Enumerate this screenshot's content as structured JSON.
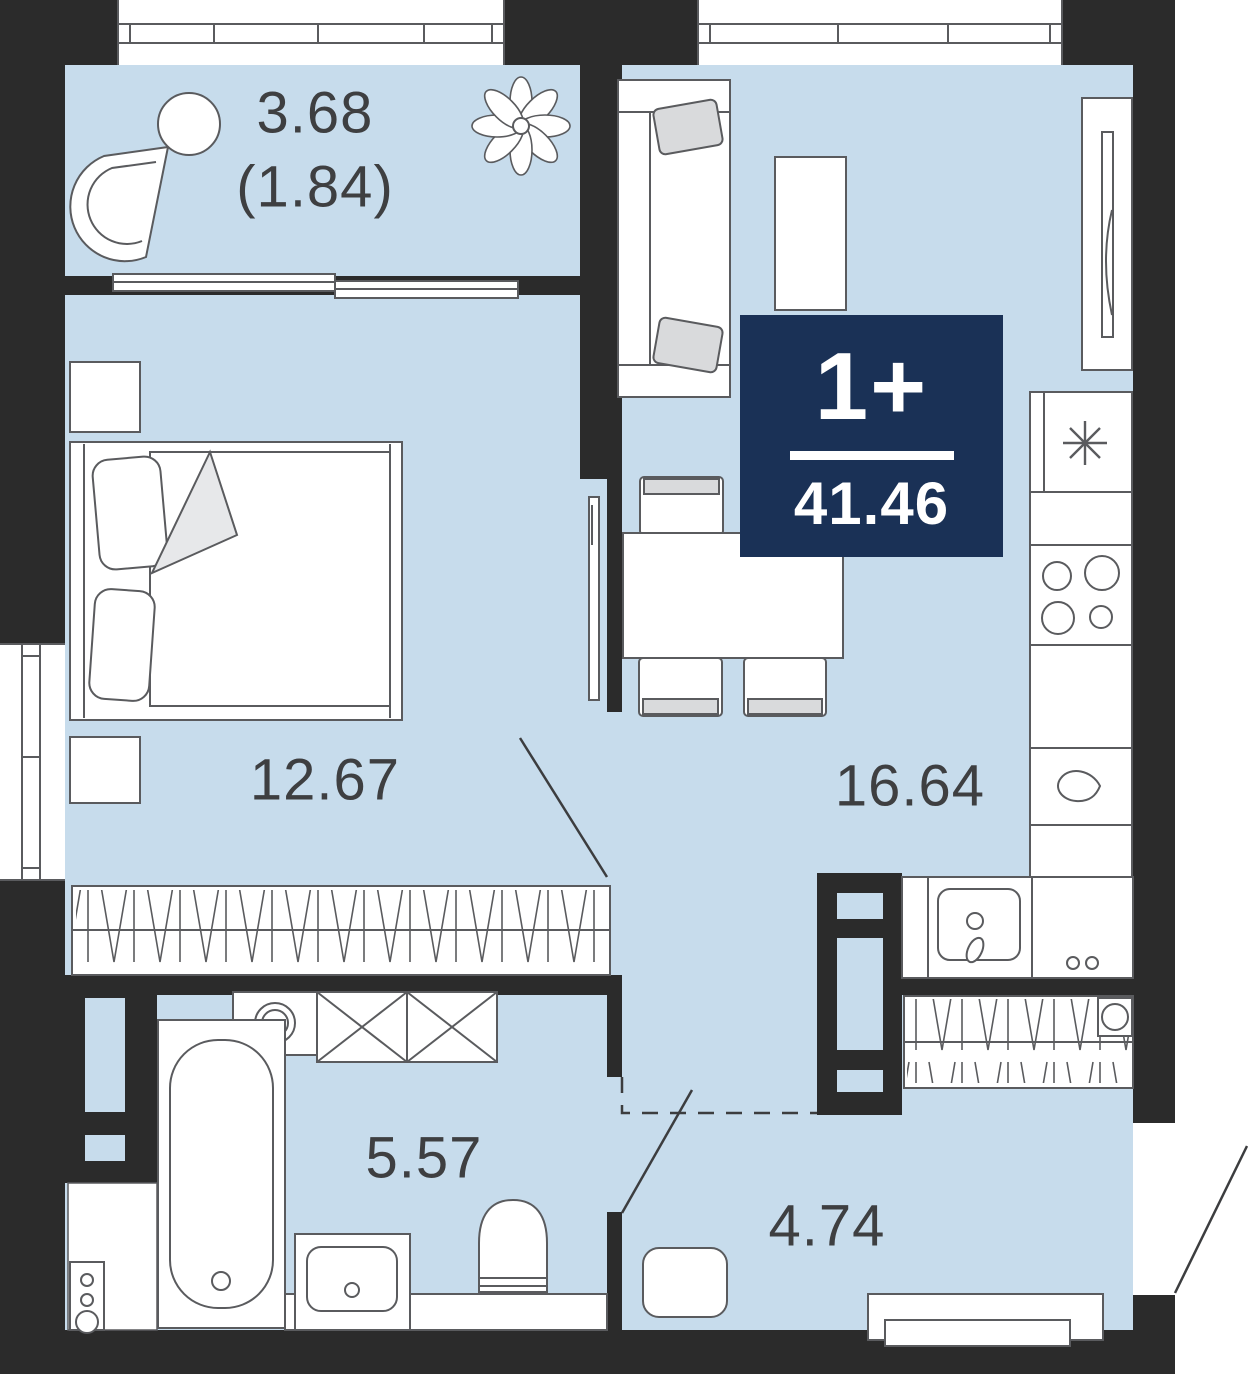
{
  "floorplan": {
    "badge": {
      "rooms_label": "1+",
      "total_area": "41.46",
      "background_color": "#1a3156",
      "text_color": "#ffffff"
    },
    "rooms": [
      {
        "name": "balcony",
        "area_label": "3.68",
        "secondary_area_label": "(1.84)",
        "furniture": [
          "armchair",
          "round-table",
          "plant"
        ]
      },
      {
        "name": "bedroom",
        "area_label": "12.67",
        "furniture": [
          "double-bed",
          "nightstand",
          "nightstand",
          "tv",
          "wardrobe"
        ]
      },
      {
        "name": "kitchen-living-room",
        "area_label": "16.64",
        "furniture": [
          "sofa",
          "coffee-table",
          "tv-cabinet",
          "fridge",
          "stove",
          "kitchen-sink",
          "kettle",
          "dining-table",
          "chairs"
        ]
      },
      {
        "name": "bathroom",
        "area_label": "5.57",
        "furniture": [
          "bathtub",
          "washing-machine",
          "storage-cabinet",
          "sink",
          "toilet",
          "boiler"
        ]
      },
      {
        "name": "hallway",
        "area_label": "4.74",
        "furniture": [
          "coat-rack",
          "mirror",
          "rug",
          "shoe-bench"
        ]
      }
    ],
    "colors": {
      "floor": "#c7dcec",
      "walls": "#2b2b2b",
      "outline": "#5a5b5e",
      "accent": "#1a3156",
      "label_text": "#3e3f41"
    }
  }
}
